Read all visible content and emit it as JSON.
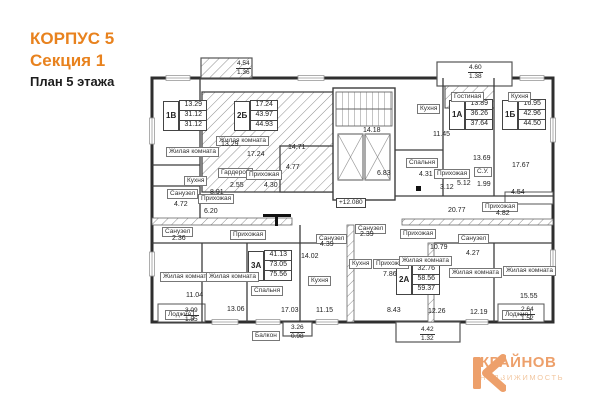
{
  "title": {
    "line1": "КОРПУС 5",
    "line2": "Секция 1",
    "line3": "План 5 этажа"
  },
  "logo": {
    "name": "КРАЙНОВ",
    "subtitle": "НЕДВИЖИМОСТЬ"
  },
  "colors": {
    "accent_orange": "#e8821e",
    "logo_orange": "#eda06b",
    "logo_light": "#f2c7a0",
    "line": "#2e2e2e",
    "hatch": "#8f8f8f"
  },
  "plan": {
    "elevation_mark": "+12.080",
    "stamps": [
      {
        "type": "1В",
        "rows": [
          "13.29",
          "31.12",
          "31.12"
        ]
      },
      {
        "type": "2Б",
        "rows": [
          "17.24",
          "43.97",
          "44.93"
        ]
      },
      {
        "type": "1А",
        "rows": [
          "13.89",
          "36.26",
          "37.64"
        ]
      },
      {
        "type": "1Б",
        "rows": [
          "16.95",
          "42.96",
          "44.50"
        ]
      },
      {
        "type": "3А",
        "rows": [
          "41.13",
          "73.05",
          "75.56"
        ]
      },
      {
        "type": "2А",
        "rows": [
          "32.76",
          "58.56",
          "59.37"
        ]
      }
    ],
    "room_labels": [
      "Жилая комната",
      "Кухня",
      "Санузел",
      "Санузел",
      "Прихожая",
      "Жилая комната",
      "Гардероб",
      "Прихожая",
      "Гостиная",
      "Кухня",
      "Кухня",
      "Спальня",
      "Прихожая",
      "С.У.",
      "Прихожая",
      "Жилая комната",
      "Жилая комната",
      "Спальня",
      "Кухня",
      "Санузел",
      "Санузел",
      "Кухня",
      "Прихожая",
      "Прихожая",
      "Жилая комната",
      "Санузел",
      "Жилая комната",
      "Жилая комната",
      "Лоджия",
      "Лоджия",
      "Балкон",
      "Прихожая"
    ],
    "dims": [
      "13.29",
      "8.91",
      "4.72",
      "2.36",
      "6.20",
      "17.24",
      "2.55",
      "4.30",
      "4.77",
      "14.71",
      "14.18",
      "11.45",
      "13.69",
      "17.67",
      "3.12",
      "5.12",
      "1.99",
      "4.54",
      "6.83",
      "4.31",
      "20.77",
      "4.82",
      "10.79",
      "4.27",
      "14.02",
      "4.39",
      "2.39",
      "7.86",
      "11.04",
      "13.06",
      "17.03",
      "11.15",
      "8.43",
      "12.26",
      "12.19",
      "15.55"
    ],
    "fracs": [
      {
        "top": "4.54",
        "bottom": "1.36"
      },
      {
        "top": "4.60",
        "bottom": "1.38"
      },
      {
        "top": "3.09",
        "bottom": "1.55"
      },
      {
        "top": "3.26",
        "bottom": "0.98"
      },
      {
        "top": "4.42",
        "bottom": "1.32"
      },
      {
        "top": "2.64",
        "bottom": "1.52"
      }
    ]
  }
}
